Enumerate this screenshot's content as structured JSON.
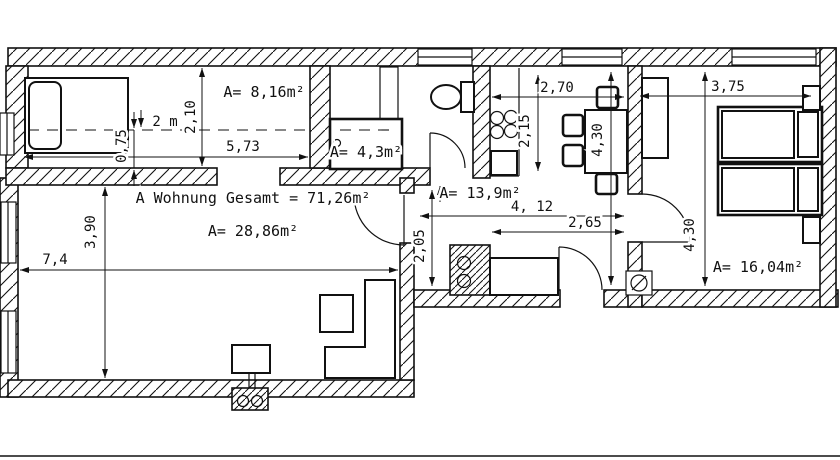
{
  "plan": {
    "total_label": "A Wohnung Gesamt = 71,26m²",
    "rooms": {
      "alcove_area": "A= 8,16m²",
      "bath_area": "A= 4,3m²",
      "living_area": "A= 28,86m²",
      "kitchen_area": "A= 13,9m²",
      "bedroom_area": "A= 16,04m²"
    },
    "dims": {
      "height_marker": "2 m",
      "alcove_width": "5,73",
      "alcove_depth": "2,10",
      "bed_offset": "0,75",
      "living_width": "7,4",
      "living_depth": "3,90",
      "kitchen_width": "2,70",
      "kitchen_depth": "2,15",
      "dining_depth": "4,30",
      "hall_total_width": "4, 12",
      "hall_width": "2,65",
      "hall_depth": "2,05",
      "bedroom_width": "3,75",
      "bedroom_depth": "4,30"
    },
    "colors": {
      "line": "#111111",
      "background": "#ffffff"
    }
  }
}
